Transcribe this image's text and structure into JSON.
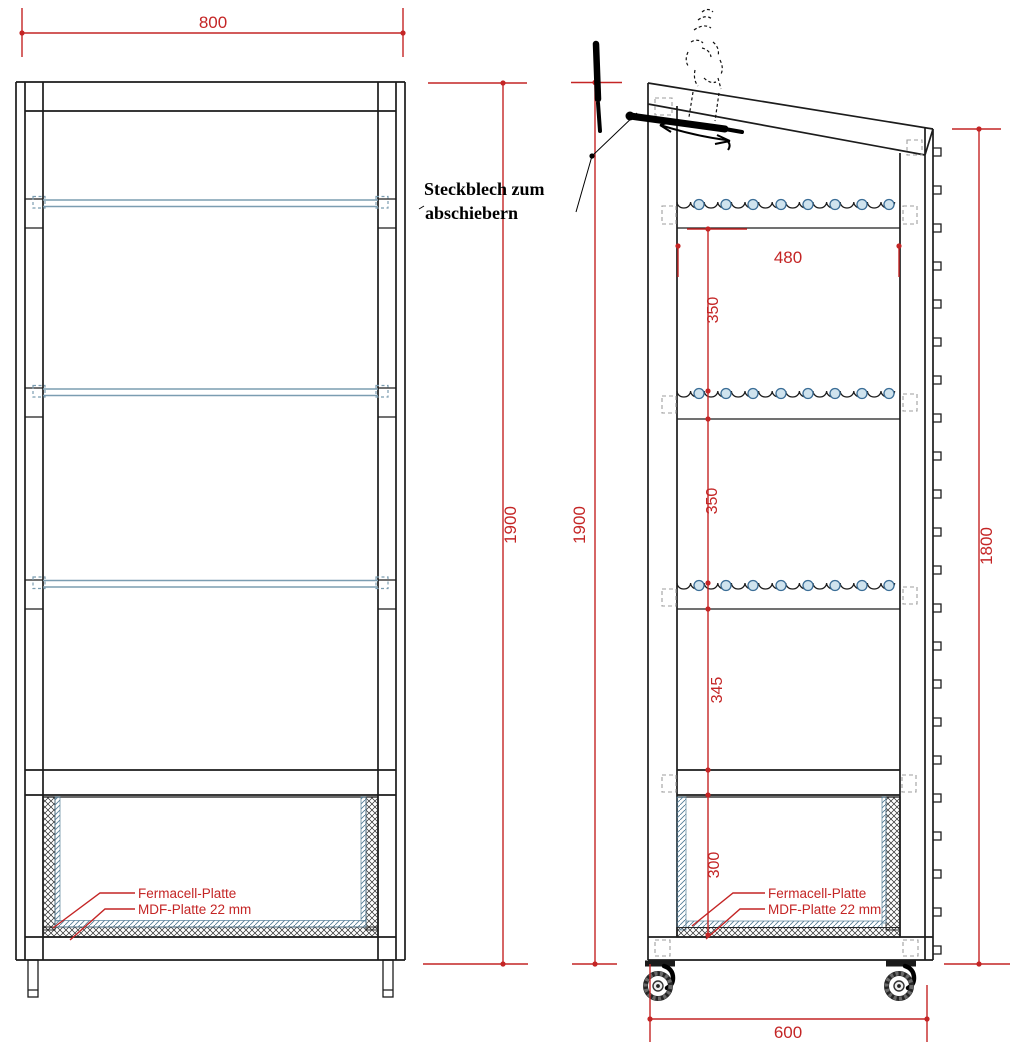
{
  "drawing": {
    "labels": {
      "front_width": "800",
      "front_height": "1900",
      "side_height": "1900",
      "back_height": "1800",
      "inner_width": "480",
      "gap1": "350",
      "gap2": "350",
      "gap3": "345",
      "gap4": "300",
      "depth": "600"
    },
    "annotations": {
      "steckblech_line1": "Steckblech zum",
      "steckblech_line2": "abschiebern",
      "front_fermacell": "Fermacell-Platte",
      "front_mdf": "MDF-Platte 22 mm",
      "side_fermacell": "Fermacell-Platte",
      "side_mdf": "MDF-Platte 22 mm"
    },
    "colors": {
      "dimension_red": "#c42525",
      "shelf_blue": "#7b9db1",
      "structure_black": "#1c1c1c"
    }
  }
}
